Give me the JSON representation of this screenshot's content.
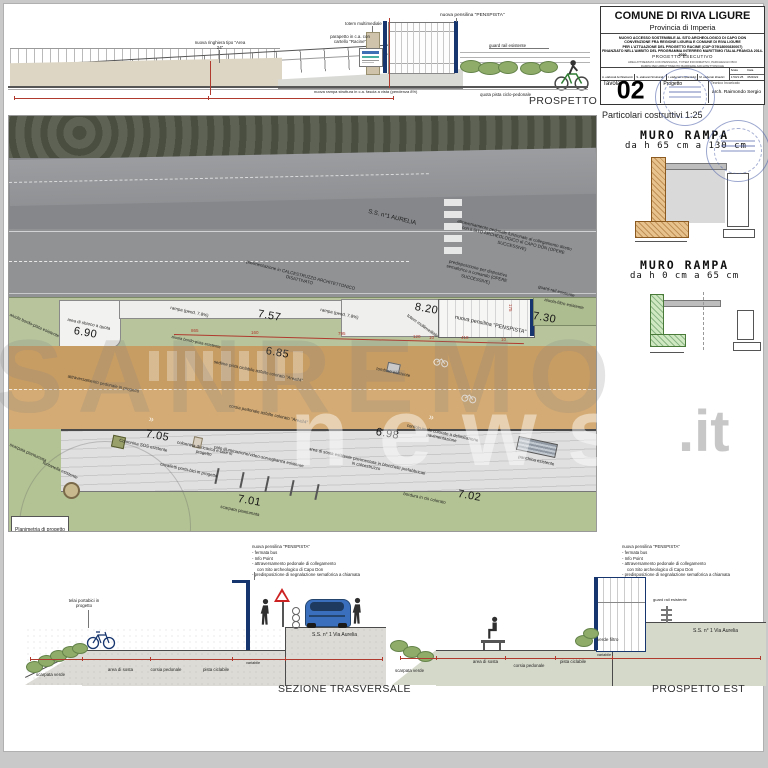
{
  "title_block": {
    "comune": "COMUNE DI RIVA LIGURE",
    "provincia": "Provincia di Imperia",
    "project_lines": [
      "NUOVO ACCESSO SOSTENIBILE AL SITO ARCHEOLOGICO DI CAPO DON",
      "CONVENZIONE FRA REGIONE LIGURIA E COMUNE DI RIVA LIGURE",
      "PER L'ATTUAZIONE DEL PROGETTO RACINE (CUP G79I18000830007)",
      "FINANZIATO NELL'AMBITO DEL PROGRAMMA INTERREG MARITTIMO ITALIA-FRANCIA 2014-2020"
    ],
    "stage": "PROGETTO ESECUTIVO",
    "subtitle_lines": [
      "AREA ATTREZZATA CON PENSILINA, TOTEM INFORMATIVO, PARCHEGGIO BICI",
      "RAMPA PER ABBATTIMENTO BARRIERE ARCHITETTONICHE"
    ],
    "categories": [
      "A. elaborati Architettonici",
      "S. elaborati Strutturali",
      "I. elaborati Impiantistici",
      "M. elaborati Idraulici"
    ],
    "scala_label": "Scala",
    "scala_value": "1:50/1:25",
    "data_label": "Data",
    "data_value": "05/2022",
    "tavola_label": "Tavola",
    "tavola_number": "02",
    "progetto_label": "Progetto",
    "tecnico_label": "Tecnico Incaricato",
    "tecnico_value": "arch. Raimondo Sergio"
  },
  "prospetto_valle": {
    "title": "PROSPETTO di VALLE",
    "label_ringhiera": "nuova ringhiera tipo \"Area 24\"",
    "label_totem": "totem multimediale",
    "label_parapetto": "parapetto in c.a. con cartello \"Racine\"",
    "label_pensilina": "nuova pensilina \"PENSPISTA\"",
    "label_guardrail": "guard rail esistente",
    "label_quota_pista": "quota pista ciclo-pedonale",
    "label_rampa": "nuova rampa struttura in c.a. fascia a vista (pendenza 8%)"
  },
  "particolari": {
    "heading": "Particolari costruttivi 1:25",
    "muro1_line1": "MURO RAMPA",
    "muro1_line2": "da h 65 cm a 130 cm",
    "muro2_line1": "MURO RAMPA",
    "muro2_line2": "da h 0 cm a 65 cm"
  },
  "plan": {
    "frame_label": "Planimetria di progetto",
    "road_name": "S.S. n°1 AURELIA",
    "note_attraversamento": "attraversamento pedonale funzionale al collegamento diretto con il SITO ARCHEOLOGICO di CAPO DON (OPERE SUCCESSIVE)",
    "note_semaforo": "predisposizione per dispositivo semaforico a comando (OPERE SUCCESSIVE)",
    "note_pavimentazione": "pavimentazione in CALCESTRUZZO ARCHITETTONICO DISATTIVATO",
    "label_guardrail": "guard-rail esistente",
    "label_aiuola_sx": "aiuola bordo-pista esistente",
    "label_aiuola_dx": "aiuola bordo-pista esistente",
    "label_sbarco": "area di sbarco a quota",
    "label_rampa1": "rampa (pend. 7.8%)",
    "label_rampa2": "rampa (pend. 7.8%)",
    "label_attraversamento": "attraversamento pedonale in progetto",
    "label_sedime": "sedime pista ciclabile asfalto colorato \"Area24\"",
    "label_tombino": "tombino esistente",
    "label_pensilina": "nuova pensilina \"PENSPISTA\"",
    "label_totem": "totem multimediale",
    "label_aiuola_filtro": "aiuola-filtro esistente",
    "label_corsia": "corsia pedonale asfalto colorato \"Area24\"",
    "label_cordolo": "cordolo in cls colorato a delimitazione pavimentazione",
    "label_panchina": "panchina esistente",
    "label_bordura": "bordura in cls colorato",
    "label_area_sosta": "area di sosta esistente pavimentata in blocchetti prefabbricati in calcestruzzo",
    "label_palo": "palo illuminazione/video-sorveglianza esistente",
    "label_ricarica": "colonnina di ricarica e-bike in progetto",
    "label_sos": "Colonnina SOS esistente",
    "label_cavalletti": "cavalletti porta-bici in progetto",
    "label_fontanella": "fontanella esistente",
    "label_scarpata1": "scarpata piantumata",
    "label_scarpata2": "scarpata piantumata",
    "elev_690": "6.90",
    "elev_757": "7.57",
    "elev_820": "8.20",
    "elev_730": "7.30",
    "elev_685": "6.85",
    "elev_698": "6.98",
    "elev_705": "7.05",
    "elev_701": "7.01",
    "elev_702": "7.02",
    "dims": {
      "d865": "865",
      "d160": "160",
      "d795": "795",
      "d120": "120",
      "d10a": "10",
      "d418": "418",
      "d10b": "10",
      "d175": "175"
    }
  },
  "sezione": {
    "title": "SEZIONE TRASVERSALE",
    "ann_title": "nuova pensilina \"PENSPISTA\"",
    "ann_1": "- fermata bus",
    "ann_2": "- Info Point",
    "ann_3": "- attraversamento pedonale di collegamento",
    "ann_3b": "con Sito archeologico di Capo Don",
    "ann_4": "- predisposizione di segnalazione semaforica a chiamata",
    "label_telai": "telai portabici in progetto",
    "label_scarpata": "scarpata verde",
    "label_sosta": "area di sosta",
    "label_corsia": "corsia pedonale",
    "label_pista": "pista ciclabile",
    "label_variabile": "variabile",
    "label_strada": "S.S. n° 1 Via Aurelia"
  },
  "prospetto_est": {
    "title": "PROSPETTO EST",
    "ann_title": "nuova pensilina \"PENSPISTA\"",
    "ann_1": "- fermata bus",
    "ann_2": "- Info Point",
    "ann_3": "- attraversamento pedonale di collegamento",
    "ann_3b": "con Sito archeologico di Capo Don",
    "ann_4": "- predisposizione di segnalazione semaforica a chiamata",
    "label_guardrail": "guard rail esistente",
    "label_verde": "verde filtro",
    "label_strada": "S.S. n° 1 Via Aurelia",
    "label_scarpata": "scarpata verde",
    "label_sosta": "area di sosta",
    "label_corsia": "corsia pedonale",
    "label_pista": "pista ciclabile",
    "label_variabile": "variabile"
  },
  "watermark": {
    "line1": "SANREMO",
    "line2": "news",
    "suffix": ".it"
  },
  "colors": {
    "pensilina_blue": "#16356e",
    "dim_red": "#b03a2e",
    "tan_band": "#cda269",
    "green_band": "#b7c49c",
    "stamp_blue": "#4a5fa8"
  }
}
